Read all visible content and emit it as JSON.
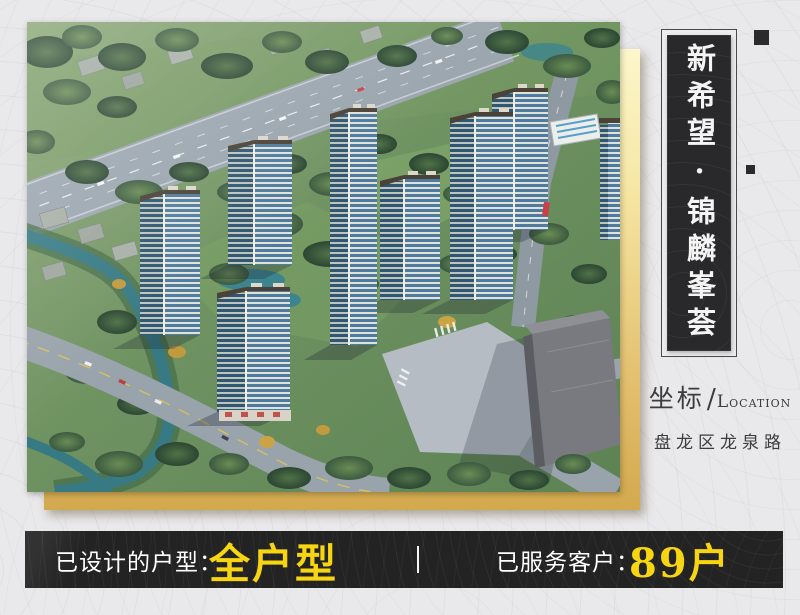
{
  "title_card": {
    "text": "新希望·锦麟峯荟"
  },
  "location": {
    "label_cn": "坐标",
    "separator": "/",
    "en_initial": "L",
    "en_rest": "OCATION",
    "address": "盘龙区龙泉路"
  },
  "stats_bar": {
    "designed_label": "已设计的户型：",
    "designed_value": "全户型",
    "served_label": "已服务客户：",
    "served_value": "89户"
  },
  "colors": {
    "accent_gold": "#d3a94e",
    "accent_gold_light": "#fdf6cc",
    "highlight_yellow": "#f7d513",
    "dark_panel": "#29292c",
    "bar_dark": "#232323",
    "text_dark": "#3c3c3e"
  }
}
